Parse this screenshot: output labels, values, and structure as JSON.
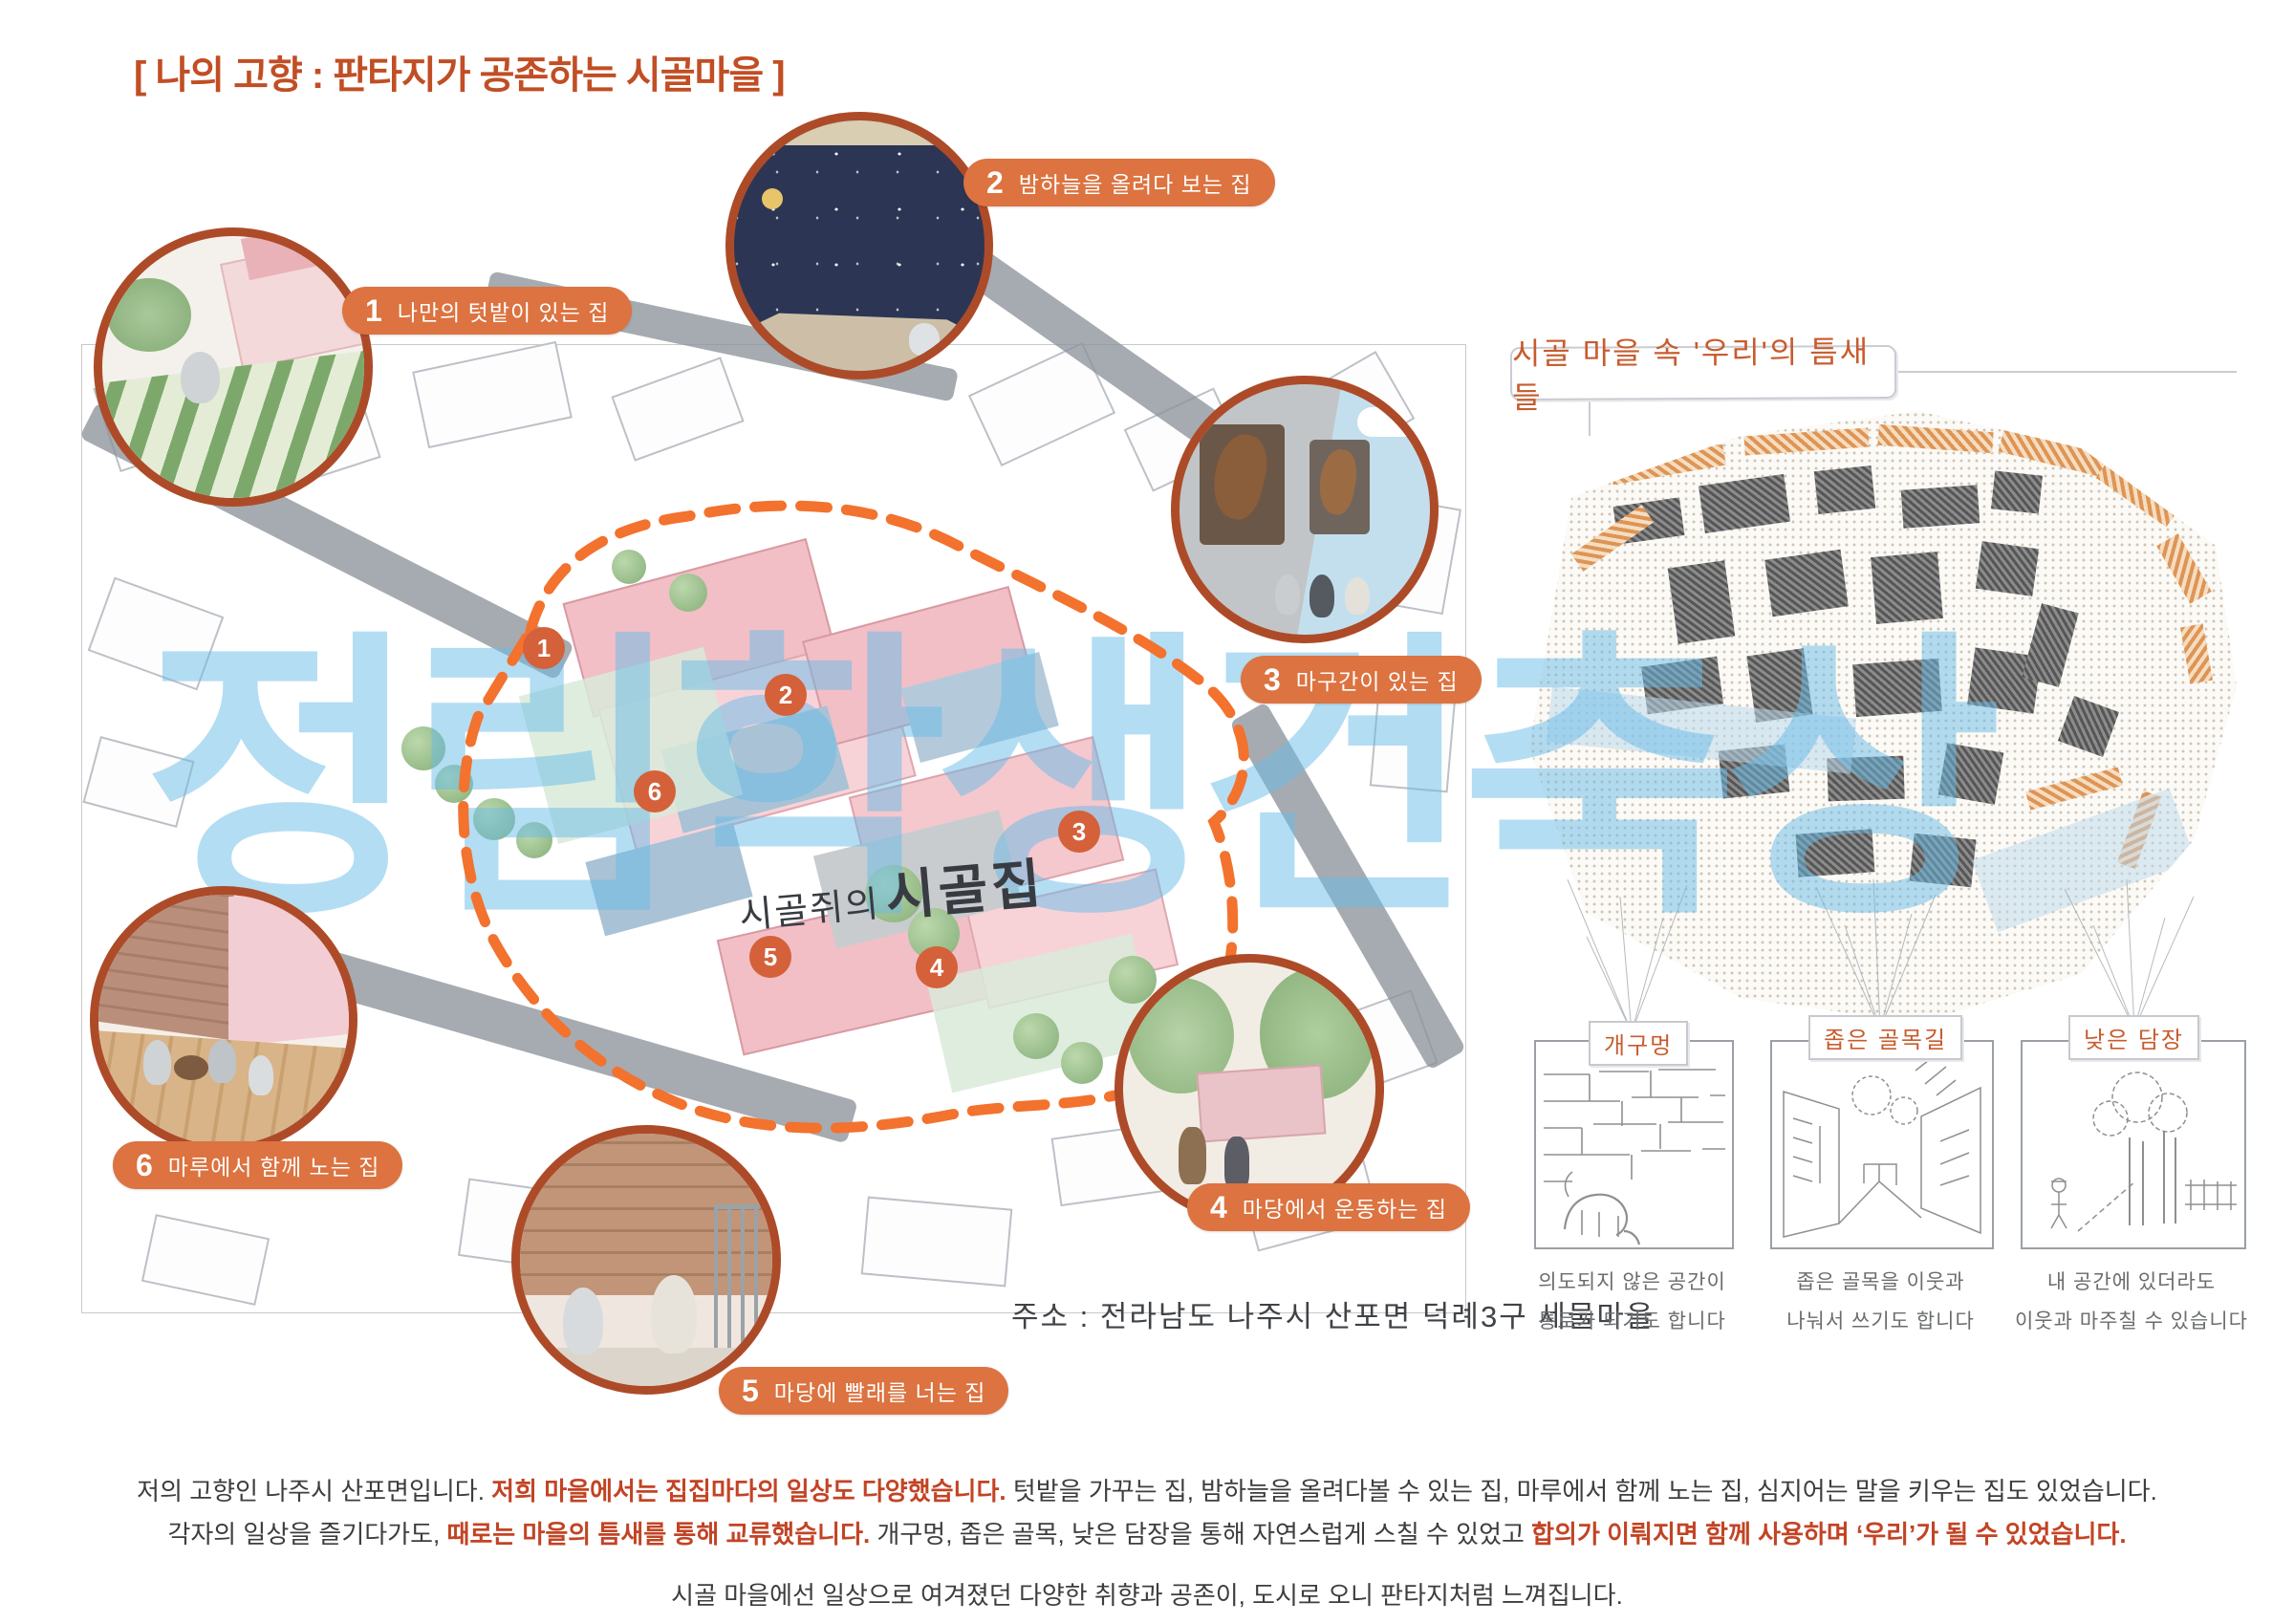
{
  "title": "[ 나의 고향 : 판타지가 공존하는 시골마을 ]",
  "watermark": "정림학생건축상",
  "map": {
    "name_small": "시골쥐의",
    "name_big": "시골집",
    "address": "주소 : 전라남도 나주시 산포면 덕례3구 세물마을"
  },
  "houses": [
    {
      "num": "1",
      "label": "나만의 텃밭이 있는 집"
    },
    {
      "num": "2",
      "label": "밤하늘을 올려다 보는 집"
    },
    {
      "num": "3",
      "label": "마구간이 있는 집"
    },
    {
      "num": "4",
      "label": "마당에서 운동하는 집"
    },
    {
      "num": "5",
      "label": "마당에 빨래를 너는 집"
    },
    {
      "num": "6",
      "label": "마루에서 함께 노는 집"
    }
  ],
  "right_panel": {
    "title": "시골 마을 속 '우리'의 틈새들",
    "sketches": [
      {
        "label": "개구멍",
        "caption1": "의도되지 않은 공간이",
        "caption2": "통로가 되기도 합니다"
      },
      {
        "label": "좁은 골목길",
        "caption1": "좁은 골목을 이웃과",
        "caption2": "나눠서 쓰기도 합니다"
      },
      {
        "label": "낮은 담장",
        "caption1": "내 공간에 있더라도",
        "caption2": "이웃과 마주칠 수 있습니다"
      }
    ]
  },
  "footer": {
    "line1_a": "저의 고향인 나주시 산포면입니다. ",
    "line1_b": "저희 마을에서는 집집마다의 일상도 다양했습니다.",
    "line1_c": " 텃밭을 가꾸는 집, 밤하늘을 올려다볼 수 있는 집, 마루에서 함께 노는 집, 심지어는 말을 키우는 집도 있었습니다.",
    "line2_a": "각자의 일상을 즐기다가도, ",
    "line2_b": "때로는 마을의 틈새를 통해 교류했습니다.",
    "line2_c": " 개구멍, 좁은 골목, 낮은 담장을 통해 자연스럽게 스칠 수 있었고 ",
    "line2_d": "합의가 이뤄지면 함께 사용하며 ‘우리’가 될 수 있었습니다.",
    "line3": "시골 마을에선 일상으로 여겨졌던 다양한 취향과 공존이, 도시로 오니 판타지처럼 느껴집니다."
  },
  "colors": {
    "title_red": "#c14e24",
    "pill_orange": "#dc7340",
    "vignette_border": "#ad4b29",
    "dashed_boundary": "#f2722e",
    "marker_orange": "#d4613a",
    "watermark_blue": "#69bce8",
    "highlight_red": "#c24425"
  }
}
